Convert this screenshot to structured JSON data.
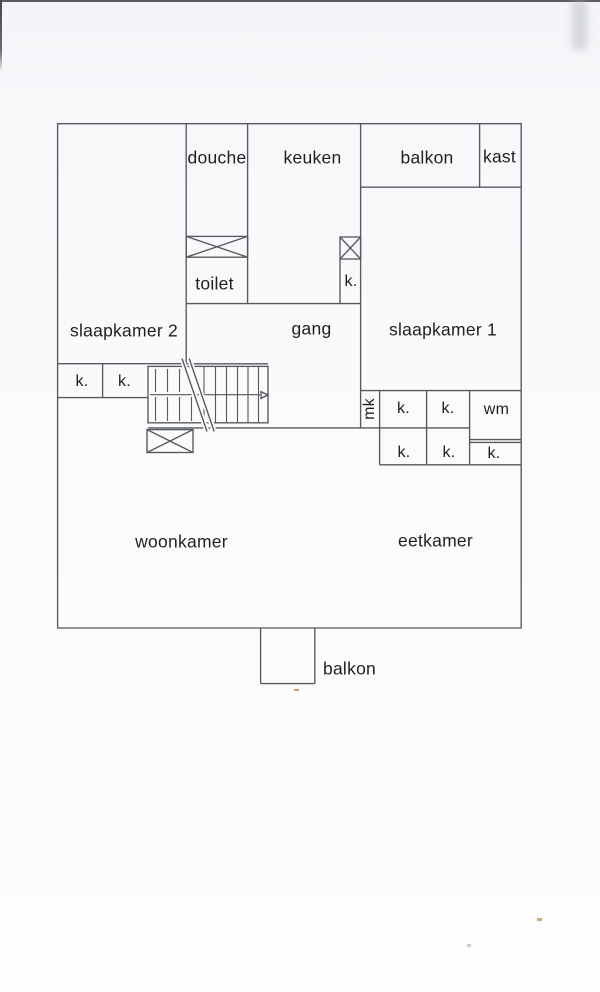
{
  "plan": {
    "rooms": {
      "douche": "douche",
      "keuken": "keuken",
      "balkon_top": "balkon",
      "kast": "kast",
      "toilet": "toilet",
      "slaapkamer2": "slaapkamer 2",
      "gang": "gang",
      "slaapkamer1": "slaapkamer 1",
      "woonkamer": "woonkamer",
      "eetkamer": "eetkamer",
      "balkon_bottom": "balkon"
    },
    "fixtures": {
      "closet": "k.",
      "wasmachine": "wm",
      "meterkast": "mk"
    },
    "colors": {
      "background": "#f5f6f8",
      "paper": "#fbfcfd",
      "line": "#55585e",
      "text": "#1e1f21"
    }
  }
}
